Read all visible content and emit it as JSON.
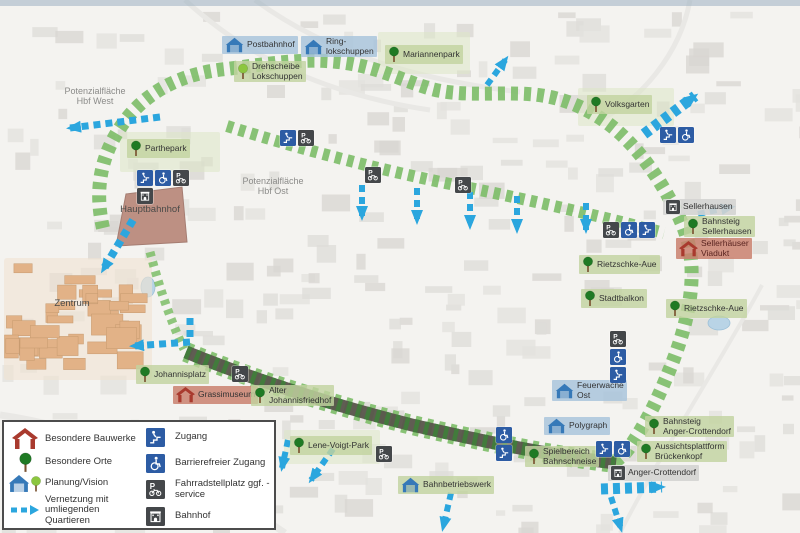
{
  "legend": {
    "left": [
      {
        "icon": "red-house",
        "label": "Besondere Bauwerke"
      },
      {
        "icon": "tree",
        "label": "Besondere Orte"
      },
      {
        "icon": "planung",
        "label": "Planung/Vision"
      },
      {
        "icon": "blue-arrow",
        "label": "Vernetzung mit umliegenden Quartieren"
      }
    ],
    "right": [
      {
        "icon": "zugang",
        "label": "Zugang"
      },
      {
        "icon": "wheelchair",
        "label": "Barrierefreier Zugang"
      },
      {
        "icon": "p-bike",
        "label": "Fahrradstellplatz ggf. -service"
      },
      {
        "icon": "bahnhof",
        "label": "Bahnhof"
      }
    ]
  },
  "map": {
    "plain_labels": [
      {
        "lines": [
          "Potenzialfläche",
          "Hbf  West"
        ],
        "x": 95,
        "y": 86,
        "muted": true
      },
      {
        "lines": [
          "Potenzialfläche",
          "Hbf  Ost"
        ],
        "x": 273,
        "y": 176,
        "muted": true
      },
      {
        "lines": [
          "Hauptbahnhof"
        ],
        "x": 150,
        "y": 205,
        "muted": false
      },
      {
        "lines": [
          "Zentrum"
        ],
        "x": 72,
        "y": 299,
        "muted": false
      }
    ],
    "labels": [
      {
        "id": "postbahnhof",
        "lines": [
          "Postbahnhof"
        ],
        "x": 222,
        "y": 36,
        "bg": "blue",
        "icon": "pavilion"
      },
      {
        "id": "ringlokschuppen",
        "lines": [
          "Ring-",
          "lokschuppen"
        ],
        "x": 301,
        "y": 36,
        "bg": "blue",
        "icon": "pavilion"
      },
      {
        "id": "drehscheibe-lokschuppen",
        "lines": [
          "Drehscheibe",
          "Lokschuppen"
        ],
        "x": 234,
        "y": 61,
        "bg": "green",
        "icon": "tree-light"
      },
      {
        "id": "mariannenpark",
        "lines": [
          "Mariannenpark"
        ],
        "x": 385,
        "y": 45,
        "bg": "green",
        "icon": "tree"
      },
      {
        "id": "volksgarten",
        "lines": [
          "Volksgarten"
        ],
        "x": 587,
        "y": 95,
        "bg": "green",
        "icon": "tree"
      },
      {
        "id": "parthepark",
        "lines": [
          "Parthepark"
        ],
        "x": 127,
        "y": 139,
        "bg": "green",
        "icon": "tree"
      },
      {
        "id": "sellerhausen",
        "lines": [
          "Sellerhausen"
        ],
        "x": 663,
        "y": 199,
        "bg": "gray",
        "icon": "bahnhof"
      },
      {
        "id": "bahnsteig-sellerhausen",
        "lines": [
          "Bahnsteig",
          "Sellerhausen"
        ],
        "x": 684,
        "y": 216,
        "bg": "green",
        "icon": "tree"
      },
      {
        "id": "sellerhaeuser-viadukt",
        "lines": [
          "Sellerhäuser",
          "Viadukt"
        ],
        "x": 676,
        "y": 238,
        "bg": "red",
        "icon": "red-house"
      },
      {
        "id": "rietzschke-aue-west",
        "lines": [
          "Rietzschke-Aue"
        ],
        "x": 579,
        "y": 255,
        "bg": "green",
        "icon": "tree"
      },
      {
        "id": "stadtbalkon",
        "lines": [
          "Stadtbalkon"
        ],
        "x": 581,
        "y": 289,
        "bg": "green",
        "icon": "tree"
      },
      {
        "id": "rietzschke-aue-ost",
        "lines": [
          "Rietzschke-Aue"
        ],
        "x": 666,
        "y": 299,
        "bg": "green",
        "icon": "tree"
      },
      {
        "id": "johannisplatz",
        "lines": [
          "Johannisplatz"
        ],
        "x": 136,
        "y": 365,
        "bg": "green",
        "icon": "tree"
      },
      {
        "id": "grassimuseum",
        "lines": [
          "Grassimuseum"
        ],
        "x": 173,
        "y": 386,
        "bg": "red",
        "icon": "red-house"
      },
      {
        "id": "alter-johannisfriedhof",
        "lines": [
          "Alter",
          "Johannisfriedhof"
        ],
        "x": 251,
        "y": 385,
        "bg": "green",
        "icon": "tree"
      },
      {
        "id": "lene-voigt-park",
        "lines": [
          "Lene-Voigt-Park"
        ],
        "x": 290,
        "y": 436,
        "bg": "green",
        "icon": "tree"
      },
      {
        "id": "spielbereich-bahnschneise",
        "lines": [
          "Spielbereich",
          "Bahnschneise"
        ],
        "x": 525,
        "y": 446,
        "bg": "green",
        "icon": "tree"
      },
      {
        "id": "polygraph",
        "lines": [
          "Polygraph"
        ],
        "x": 544,
        "y": 417,
        "bg": "blue",
        "icon": "pavilion"
      },
      {
        "id": "feuerwache-ost",
        "lines": [
          "Feuerwache",
          "Ost"
        ],
        "x": 552,
        "y": 380,
        "bg": "blue",
        "icon": "pavilion"
      },
      {
        "id": "bahnbetriebswerk",
        "lines": [
          "Bahnbetriebswerk"
        ],
        "x": 398,
        "y": 476,
        "bg": "green",
        "icon": "pavilion"
      },
      {
        "id": "bahnsteig-anger-crottendorf",
        "lines": [
          "Bahnsteig",
          "Anger-Crottendorf"
        ],
        "x": 645,
        "y": 416,
        "bg": "green",
        "icon": "tree"
      },
      {
        "id": "aussichtsplattform-brueckenkopf",
        "lines": [
          "Aussichtsplattform",
          "Brückenkopf"
        ],
        "x": 637,
        "y": 441,
        "bg": "green",
        "icon": "tree"
      },
      {
        "id": "anger-crottendorf",
        "lines": [
          "Anger-Crottendorf"
        ],
        "x": 608,
        "y": 465,
        "bg": "gray",
        "icon": "bahnhof"
      }
    ],
    "icon_clusters": [
      {
        "x": 137,
        "y": 170,
        "dir": "h",
        "icons": [
          "zugang",
          "wheelchair",
          "p-bike"
        ]
      },
      {
        "x": 137,
        "y": 188,
        "dir": "h",
        "icons": [
          "bahnhof"
        ]
      },
      {
        "x": 280,
        "y": 130,
        "dir": "h",
        "icons": [
          "zugang",
          "p-bike"
        ]
      },
      {
        "x": 365,
        "y": 167,
        "dir": "h",
        "icons": [
          "p-bike"
        ]
      },
      {
        "x": 455,
        "y": 177,
        "dir": "h",
        "icons": [
          "p-bike"
        ]
      },
      {
        "x": 660,
        "y": 127,
        "dir": "h",
        "icons": [
          "zugang",
          "wheelchair"
        ]
      },
      {
        "x": 603,
        "y": 222,
        "dir": "h",
        "icons": [
          "p-bike",
          "wheelchair",
          "zugang"
        ]
      },
      {
        "x": 610,
        "y": 331,
        "dir": "v",
        "icons": [
          "p-bike",
          "wheelchair",
          "zugang"
        ]
      },
      {
        "x": 496,
        "y": 427,
        "dir": "v",
        "icons": [
          "wheelchair",
          "zugang"
        ]
      },
      {
        "x": 596,
        "y": 441,
        "dir": "h",
        "icons": [
          "zugang",
          "wheelchair"
        ]
      },
      {
        "x": 376,
        "y": 446,
        "dir": "h",
        "icons": [
          "p-bike"
        ]
      },
      {
        "x": 232,
        "y": 366,
        "dir": "h",
        "icons": [
          "p-bike"
        ]
      }
    ],
    "arrows": [
      {
        "points": [
          [
            160,
            117
          ],
          [
            70,
            128
          ]
        ],
        "w": 7
      },
      {
        "points": [
          [
            133,
            220
          ],
          [
            103,
            270
          ]
        ],
        "w": 8
      },
      {
        "points": [
          [
            190,
            318
          ],
          [
            190,
            342
          ],
          [
            133,
            346
          ]
        ],
        "w": 7
      },
      {
        "points": [
          [
            487,
            85
          ],
          [
            506,
            59
          ]
        ],
        "w": 6
      },
      {
        "points": [
          [
            644,
            134
          ],
          [
            695,
            96
          ]
        ],
        "w": 11
      },
      {
        "points": [
          [
            362,
            185
          ],
          [
            362,
            217
          ]
        ],
        "w": 6
      },
      {
        "points": [
          [
            417,
            188
          ],
          [
            417,
            221
          ]
        ],
        "w": 6
      },
      {
        "points": [
          [
            470,
            192
          ],
          [
            470,
            226
          ]
        ],
        "w": 6
      },
      {
        "points": [
          [
            517,
            196
          ],
          [
            517,
            230
          ]
        ],
        "w": 6
      },
      {
        "points": [
          [
            586,
            203
          ],
          [
            586,
            230
          ]
        ],
        "w": 6
      },
      {
        "points": [
          [
            698,
            214
          ],
          [
            732,
            207
          ]
        ],
        "w": 6
      },
      {
        "points": [
          [
            333,
            449
          ],
          [
            311,
            480
          ]
        ],
        "w": 6
      },
      {
        "points": [
          [
            288,
            440
          ],
          [
            282,
            468
          ]
        ],
        "w": 6
      },
      {
        "points": [
          [
            451,
            493
          ],
          [
            443,
            528
          ]
        ],
        "w": 6
      },
      {
        "points": [
          [
            601,
            489
          ],
          [
            662,
            487
          ]
        ],
        "w": 11
      },
      {
        "points": [
          [
            611,
            497
          ],
          [
            621,
            529
          ]
        ],
        "w": 6
      }
    ],
    "routes": {
      "green_main": "M 103,228 C 93,185 103,148 128,117 C 152,88 186,73 226,69 C 268,64 306,57 346,63 C 379,68 399,79 428,88 C 458,97 493,92 528,94 C 559,96 583,106 606,122 C 630,139 652,167 668,196 C 681,219 689,237 691,260 C 694,292 686,327 673,361 C 661,392 648,421 629,448 C 623,456 617,461 611,463",
      "green_connector": "M 150,252 C 159,286 170,320 184,349",
      "green_middle": "M 227,126 C 300,149 380,170 460,186 C 540,202 612,219 664,233",
      "dark_band": "M 186,352 C 252,379 332,405 412,425 C 482,441 552,456 616,463"
    },
    "buildings": {
      "hauptbahnhof_points": "116,246 126,194 182,187 187,242",
      "zentrum_area": {
        "x": 4,
        "y": 258,
        "w": 148,
        "h": 122
      }
    },
    "ponds": [
      {
        "cx": 719,
        "cy": 323,
        "rx": 11,
        "ry": 7
      },
      {
        "cx": 148,
        "cy": 287,
        "rx": 7,
        "ry": 10
      }
    ],
    "park_patches": [
      {
        "x": 378,
        "y": 32,
        "w": 92,
        "h": 42
      },
      {
        "x": 578,
        "y": 88,
        "w": 96,
        "h": 38
      },
      {
        "x": 284,
        "y": 430,
        "w": 96,
        "h": 34
      },
      {
        "x": 120,
        "y": 132,
        "w": 100,
        "h": 40
      }
    ],
    "colors": {
      "accent_blue": "#2ba6de",
      "icon_blue": "#2d5ca4",
      "icon_dark": "#44474a",
      "route_green": "#7cbd67",
      "route_dark": "#5a564c",
      "route_dark_hatch": "#3f7e3a",
      "label_green": "#c2d3a0",
      "label_blue": "#a9c4dc",
      "label_gray": "#d4d4d2",
      "label_red": "#c9806f",
      "building_red": "#a93a2e",
      "pavilion_blue": "#3679b8",
      "tree_green": "#1f7a24",
      "tree_light": "#8cc63f",
      "zentrum_fill": "#e2b287",
      "hauptbahnhof_fill": "#bd9083"
    }
  }
}
